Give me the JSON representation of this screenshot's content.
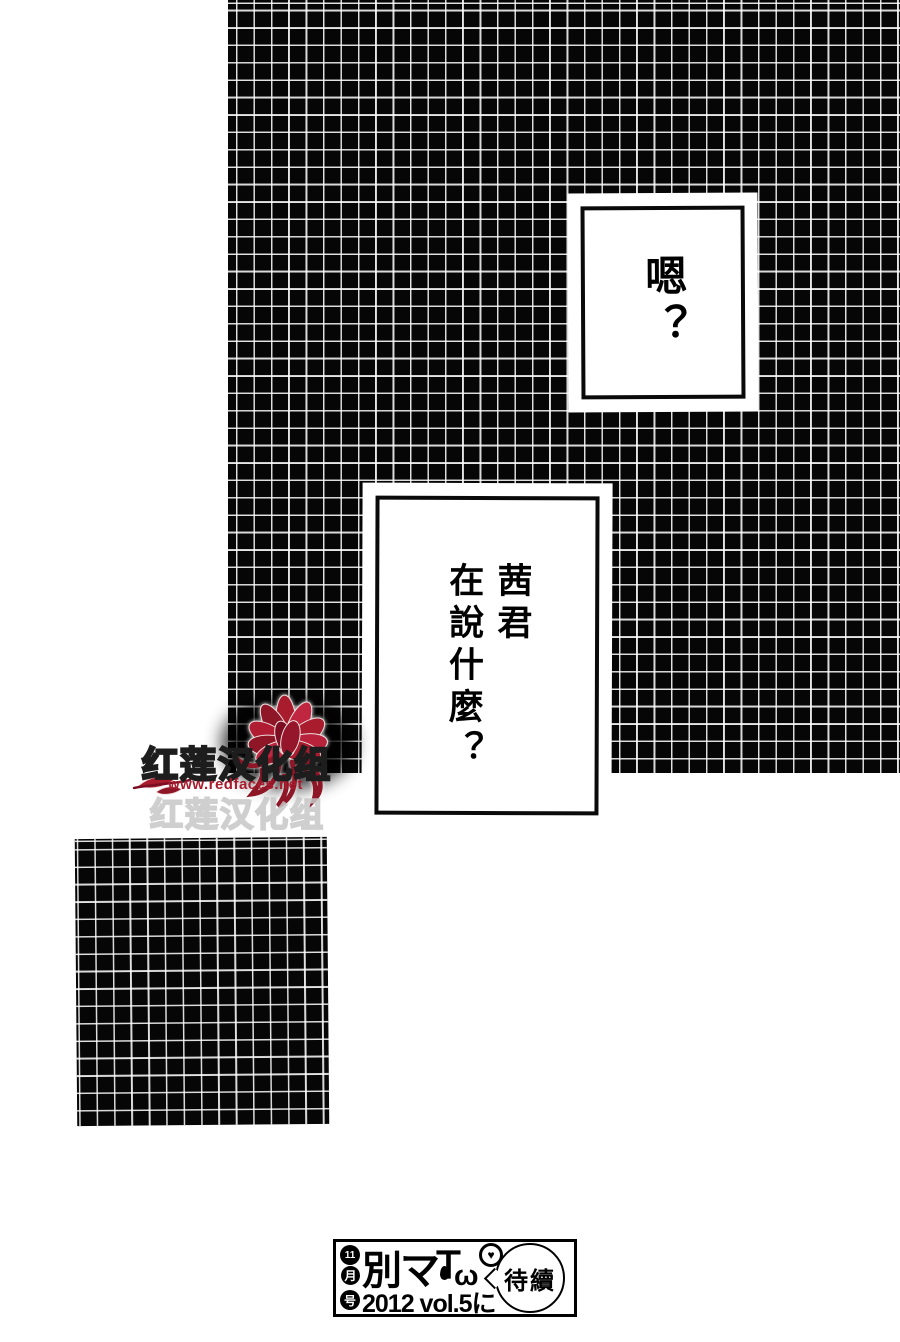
{
  "page": {
    "type": "manga-page",
    "background": "#ffffff",
    "ink": "#000000"
  },
  "speech_bubbles": {
    "bubble1": {
      "text": "嗯？"
    },
    "bubble2": {
      "column1": "茜君",
      "column2": "在說什麼？"
    }
  },
  "watermark": {
    "group_name": "红莲汉化组",
    "group_name_ghost": "红莲汉化组",
    "url": "www.redfaces.net",
    "flower_icon": "red-lotus-flower",
    "accent_red": "#a81c2e"
  },
  "footer": {
    "issue_circles": [
      "11",
      "月",
      "号"
    ],
    "magazine_logo": "別マ",
    "logo_face_t": "Ｔ",
    "logo_face_mouth": "ω",
    "logo_heart": "♥",
    "issue_info": "2012 vol.5に",
    "continuation_bubble": "待續"
  }
}
